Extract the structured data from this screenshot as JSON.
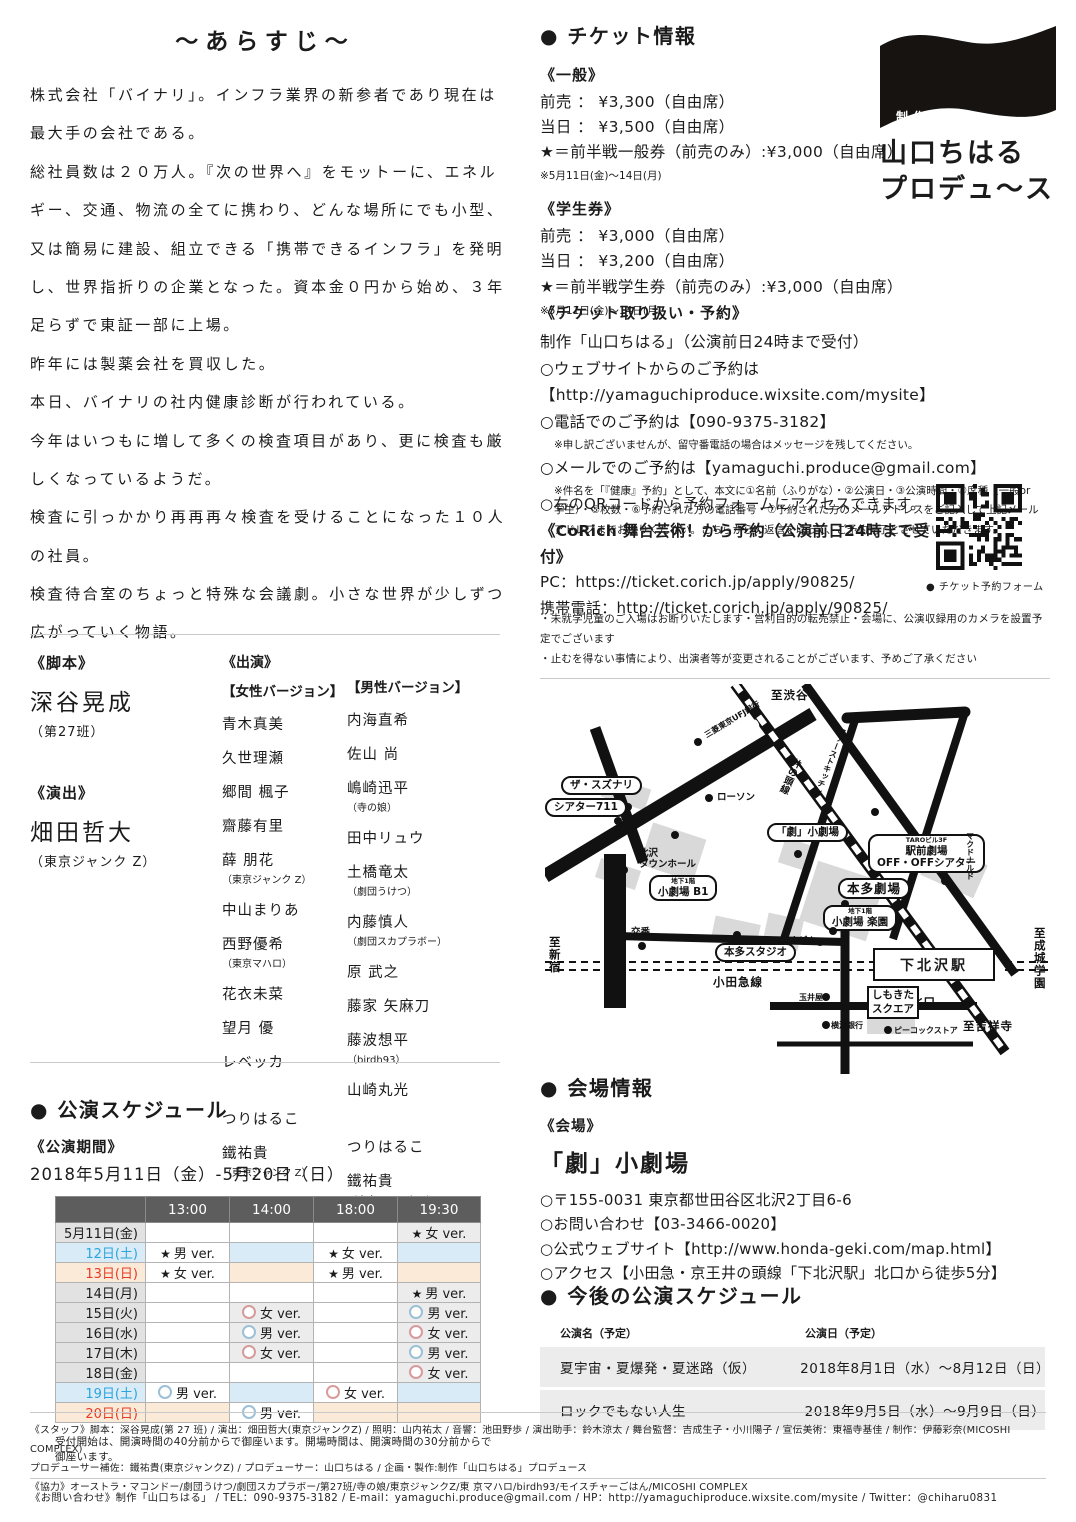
{
  "synopsis": {
    "title": "～あらすじ～",
    "paragraphs": [
      "株式会社「バイナリ」。インフラ業界の新参者であり現在は最大手の会社である。",
      "総社員数は２０万人。『次の世界へ』をモットーに、エネルギー、交通、物流の全てに携わり、どんな場所にでも小型、又は簡易に建設、組立できる「携帯できるインフラ」を発明し、世界指折りの企業となった。資本金０円から始め、３年足らずで東証一部に上場。",
      "昨年には製薬会社を買収した。",
      "本日、バイナリの社内健康診断が行われている。",
      "今年はいつもに増して多くの検査項目があり、更に検査も厳しくなっているようだ。",
      "検査に引っかかり再再再々検査を受けることになった１０人の社員。",
      "検査待合室のちょっと特殊な会議劇。小さな世界が少しずつ広がっていく物語。"
    ]
  },
  "credits": {
    "script_label": "《脚本》",
    "script_name": "深谷晃成",
    "script_note": "（第27班）",
    "direction_label": "《演出》",
    "direction_name": "畑田哲大",
    "direction_note": "（東京ジャンク Z）"
  },
  "cast": {
    "label": "《出演》",
    "female_label": "【女性バージョン】",
    "male_label": "【男性バージョン】",
    "female": [
      {
        "n": "青木真美"
      },
      {
        "n": "久世理瀬"
      },
      {
        "n": "郷間 楓子"
      },
      {
        "n": "齋藤有里"
      },
      {
        "n": "薛 朋花",
        "note": "（東京ジャンク Z）"
      },
      {
        "n": "中山まりあ"
      },
      {
        "n": "西野優希",
        "note": "（東京マハロ）"
      },
      {
        "n": "花衣未菜"
      },
      {
        "n": "望月 優"
      },
      {
        "n": "レベッカ"
      },
      {
        "n": "つりはるこ",
        "gap": true
      },
      {
        "n": "鐵祐貴",
        "note": "（東京ジャンク Z）"
      }
    ],
    "male": [
      {
        "n": "内海直希"
      },
      {
        "n": "佐山 尚"
      },
      {
        "n": "嶋崎迅平",
        "note": "（寺の娘）"
      },
      {
        "n": "田中リュウ"
      },
      {
        "n": "土橋竜太",
        "note": "（劇団うけつ）"
      },
      {
        "n": "内藤慎人",
        "note": "（劇団スカプラボー）"
      },
      {
        "n": "原 武之"
      },
      {
        "n": "藤家 矢麻刀"
      },
      {
        "n": "藤波想平",
        "note": "（birdh93）"
      },
      {
        "n": "山崎丸光"
      },
      {
        "n": "つりはるこ",
        "gap": true
      },
      {
        "n": "鐵祐貴",
        "note": "（東京ジャンク Z）"
      }
    ]
  },
  "schedule": {
    "heading": "● 公演スケジュール",
    "period_label": "《公演期間》",
    "period": "2018年5月11日（金）-5月20日（日）",
    "times": [
      "13:00",
      "14:00",
      "18:00",
      "19:30"
    ],
    "rows": [
      {
        "date": "5月11日(金)",
        "day": "normal",
        "cells": [
          null,
          null,
          null,
          {
            "m": "star",
            "t": "女 ver."
          }
        ]
      },
      {
        "date": "12日(土)",
        "day": "sat",
        "cells": [
          {
            "m": "star",
            "t": "男 ver."
          },
          null,
          {
            "m": "star",
            "t": "女 ver."
          },
          null
        ]
      },
      {
        "date": "13日(日)",
        "day": "sun",
        "cells": [
          {
            "m": "star",
            "t": "女 ver."
          },
          null,
          {
            "m": "star",
            "t": "男 ver."
          },
          null
        ]
      },
      {
        "date": "14日(月)",
        "day": "normal",
        "cells": [
          null,
          null,
          null,
          {
            "m": "star",
            "t": "男 ver."
          }
        ]
      },
      {
        "date": "15日(火)",
        "day": "normal",
        "cells": [
          null,
          {
            "m": "pink",
            "t": "女 ver."
          },
          null,
          {
            "m": "blue",
            "t": "男 ver."
          }
        ]
      },
      {
        "date": "16日(水)",
        "day": "normal",
        "cells": [
          null,
          {
            "m": "blue",
            "t": "男 ver."
          },
          null,
          {
            "m": "pink",
            "t": "女 ver."
          }
        ]
      },
      {
        "date": "17日(木)",
        "day": "normal",
        "cells": [
          null,
          {
            "m": "pink",
            "t": "女 ver."
          },
          null,
          {
            "m": "blue",
            "t": "男 ver."
          }
        ]
      },
      {
        "date": "18日(金)",
        "day": "normal",
        "cells": [
          null,
          null,
          null,
          {
            "m": "pink",
            "t": "女 ver."
          }
        ]
      },
      {
        "date": "19日(土)",
        "day": "sat",
        "cells": [
          {
            "m": "blue",
            "t": "男 ver."
          },
          null,
          {
            "m": "pink",
            "t": "女 ver."
          },
          null
        ]
      },
      {
        "date": "20日(日)",
        "day": "sun",
        "cells": [
          null,
          {
            "m": "blue",
            "t": "男 ver."
          },
          null,
          null
        ]
      }
    ],
    "note": "受付開始は、開演時間の40分前からで御座います。開場時間は、開演時間の30分前からで御座います。"
  },
  "tickets": {
    "heading": "● チケット情報",
    "general": {
      "label": "《一般》",
      "lines": [
        "前売 ： ¥3,300（自由席）",
        "当日 ： ¥3,500（自由席）",
        "★＝前半戦一般券（前売のみ）:¥3,000（自由席）"
      ],
      "note": "※5月11日(金)～14日(月)"
    },
    "student": {
      "label": "《学生券》",
      "lines": [
        "前売 ： ¥3,000（自由席）",
        "当日 ： ¥3,200（自由席）",
        "★＝前半戦学生券（前売のみ）:¥3,000（自由席）"
      ],
      "note": "※5月11日(金)～14日(月)"
    }
  },
  "reservation": {
    "label": "《チケット取り扱い・予約》",
    "lines": [
      {
        "t": "制作「山口ちはる」（公演前日24時まで受付）"
      },
      {
        "t": "○ウェブサイトからのご予約は"
      },
      {
        "t": "【http://yamaguchiproduce.wixsite.com/mysite】"
      },
      {
        "t": "○電話でのご予約は【090-9375-3182】"
      },
      {
        "t": "※申し訳ございませんが、留守番電話の場合はメッセージを残してください。",
        "small": true
      },
      {
        "t": "○メールでのご予約は【yamaguchi.produce@gmail.com】"
      },
      {
        "t": "※件名を「『健康』予約」として、本文に①名前（ふりがな）・②公演日・③公演時間・④席種（一般or学生）・⑤枚数・⑥予約された方の電話番号・⑦予約された方のメールアドレスをご記入して上記メールアドレスまでお送りください。こちらからの返信を以って、ご予約完了とさせていただきます。",
        "small": true
      }
    ]
  },
  "qr": {
    "lines": [
      "○右のQRコードから予約フォームにアクセスできます。",
      "《CoRich 舞台芸術！から予約（公演前日24時まで受付》",
      "PC：https://ticket.corich.jp/apply/90825/",
      "携帯電話：http://ticket.corich.jp/apply/90825/"
    ],
    "caption": "● チケット予約フォーム"
  },
  "notices": [
    "・未就学児童のご入場はお断りいたします・営利目的の転売禁止・会場に、公演収録用のカメラを設置予定でございます",
    "・止むを得ない事情により、出演者等が変更されることがございます、予めご了承ください"
  ],
  "logo": {
    "seisaku": "制作",
    "name_line1": "山口ちはる",
    "name_line2": "プロデュ～ス"
  },
  "map": {
    "station": "下北沢駅",
    "labels": [
      {
        "t": "至渋谷",
        "x": 226,
        "y": 5,
        "c": "m-plain m-bold"
      },
      {
        "t": "茶沢通り",
        "x": 158,
        "y": 64,
        "c": "m-road",
        "r": -31
      },
      {
        "t": "三菱東京UFJ銀行",
        "x": 158,
        "y": 48,
        "c": "m-tiny",
        "r": -31,
        "dot": [
          153,
          58
        ]
      },
      {
        "t": "ザ・スズナリ",
        "x": 16,
        "y": 92,
        "c": "m-callout",
        "dot": [
          83,
          123
        ]
      },
      {
        "t": "シアター711",
        "x": 0,
        "y": 114,
        "c": "m-callout",
        "dot": [
          73,
          137
        ]
      },
      {
        "t": "ローソン",
        "x": 172,
        "y": 108,
        "c": "m-small",
        "dot": [
          164,
          114
        ]
      },
      {
        "t": "北沢\nタウンホール",
        "x": 94,
        "y": 164,
        "c": "m-small",
        "dot": [
          130,
          151
        ]
      },
      {
        "t": "「劇」小劇場",
        "x": 222,
        "y": 139,
        "c": "m-callout",
        "dot": [
          253,
          170
        ]
      },
      {
        "lines": [
          {
            "t": "地下1階",
            "sm": true
          },
          {
            "t": "小劇場 B1"
          }
        ],
        "x": 104,
        "y": 191,
        "c": "m-callout",
        "dot": [
          79,
          186
        ]
      },
      {
        "lines": [
          {
            "t": "TAROビル3F",
            "sm": true
          },
          {
            "t": "駅前劇場"
          },
          {
            "t": "OFF・OFFシアター"
          }
        ],
        "x": 323,
        "y": 150,
        "c": "m-callout",
        "dot": [
          400,
          197
        ]
      },
      {
        "t": "マクドナルド",
        "x": 420,
        "y": 148,
        "c": "m-vert m-tiny"
      },
      {
        "t": "本多劇場",
        "x": 293,
        "y": 194,
        "c": "m-callout m-big",
        "dot": [
          300,
          220
        ]
      },
      {
        "lines": [
          {
            "t": "地下1階",
            "sm": true
          },
          {
            "t": "小劇場 楽園"
          }
        ],
        "x": 278,
        "y": 221,
        "c": "m-callout",
        "dot": [
          288,
          247
        ]
      },
      {
        "t": "交番",
        "x": 86,
        "y": 243,
        "c": "m-small",
        "dot": [
          97,
          262
        ]
      },
      {
        "t": "本多スタジオ",
        "x": 170,
        "y": 259,
        "c": "m-callout",
        "dot": [
          192,
          251
        ]
      },
      {
        "t": "オオゼキ",
        "x": 234,
        "y": 252,
        "c": "m-small",
        "dot": [
          275,
          258
        ]
      },
      {
        "t": "ファーストキッチン",
        "x": 294,
        "y": 42,
        "c": "m-vert m-tiny",
        "r": 22,
        "dot": [
          330,
          128
        ]
      },
      {
        "t": "井の頭線",
        "x": 247,
        "y": 72,
        "c": "m-vert m-small",
        "r": 24
      },
      {
        "t": "至新宿",
        "x": 2,
        "y": 252,
        "c": "m-vert m-bold"
      },
      {
        "t": "小田急線",
        "x": 168,
        "y": 292,
        "c": "m-plain m-bold"
      },
      {
        "t": "至成城学園",
        "x": 487,
        "y": 243,
        "c": "m-vert m-bold"
      },
      {
        "t": "北口",
        "x": 366,
        "y": 312,
        "c": "m-plain m-bold"
      },
      {
        "t": "至吉祥寺",
        "x": 418,
        "y": 336,
        "c": "m-plain m-bold"
      },
      {
        "t": "玉井屋",
        "x": 254,
        "y": 309,
        "c": "m-tiny",
        "dot": [
          281,
          313
        ]
      },
      {
        "t": "横浜銀行",
        "x": 286,
        "y": 337,
        "c": "m-tiny",
        "dot": [
          281,
          341
        ]
      },
      {
        "t": "ピーコックストア",
        "x": 349,
        "y": 342,
        "c": "m-tiny",
        "dot": [
          343,
          346
        ]
      },
      {
        "lines": [
          {
            "t": "しもきた"
          },
          {
            "t": "スクエア"
          }
        ],
        "x": 322,
        "y": 302,
        "c": "m-box"
      }
    ]
  },
  "venue": {
    "heading": "● 会場情報",
    "label": "《会場》",
    "name": "「劇」小劇場",
    "lines": [
      "○〒155-0031 東京都世田谷区北沢2丁目6-6",
      "○お問い合わせ【03-3466-0020】",
      "○公式ウェブサイト【http://www.honda-geki.com/map.html】",
      "○アクセス【小田急・京王井の頭線「下北沢駅」北口から徒歩5分】"
    ]
  },
  "future": {
    "heading": "● 今後の公演スケジュール",
    "col1": "公演名（予定）",
    "col2": "公演日（予定）",
    "rows": [
      [
        "夏宇宙・夏爆発・夏迷路（仮）",
        "2018年8月1日（水）～8月12日（日）"
      ],
      [
        "ロックでもない人生",
        "2018年9月5日（水）～9月9日（日）"
      ]
    ]
  },
  "footer": {
    "staff_lines": [
      "《スタッフ》脚本：深谷晃成(第 27 班) / 演出：畑田哲大(東京ジャンクZ) / 照明：山内祐太 / 音響：池田野歩 / 演出助手：鈴木涼太 / 舞台監督：吉成生子・小川陽子 / 宣伝美術：東福寺基佳 / 制作：伊藤彩奈(MICOSHI COMPLEX)",
      "プロデューサー補佐：鐵祐貴(東京ジャンクZ) / プロデューサー：山口ちはる / 企画・製作:制作「山口ちはる」プロデュース",
      "《協力》オーストラ・マコンドー/劇団うけつ/劇団スカプラボー/第27班/寺の娘/東京ジャンクZ/東 京マハロ/birdh93/モイスチャーごはん/MICOSHI COMPLEX"
    ],
    "contact_line": "《お問い合わせ》制作「山口ちはる」 / TEL：090-9375-3182 / E-mail：yamaguchi.produce@gmail.com / HP：http://yamaguchiproduce.wixsite.com/mysite / Twitter：@chiharu0831"
  }
}
